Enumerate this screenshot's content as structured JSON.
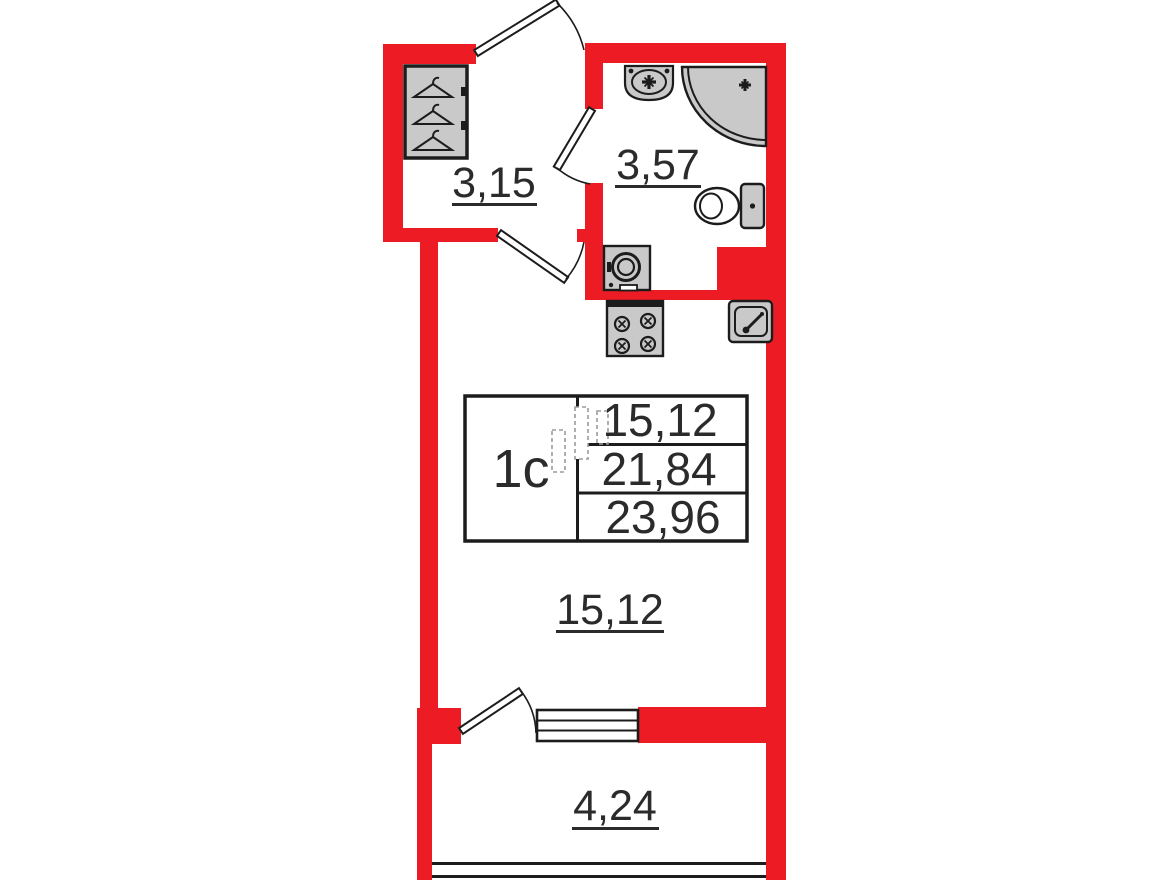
{
  "colors": {
    "wall": "#ed1c24",
    "fixture_fill": "#c9c9c9",
    "outline": "#1c1c1c",
    "label_text": "#2b2b2b"
  },
  "info_box": {
    "unit_type": "1c",
    "values": [
      "15,12",
      "21,84",
      "23,96"
    ]
  },
  "room_labels": {
    "entry_hall": "3,15",
    "bathroom": "3,57",
    "main_room": "15,12",
    "balcony": "4,24"
  },
  "fixture_icons": [
    "wardrobe-hangers-icon",
    "bathroom-sink-icon",
    "corner-shower-icon",
    "toilet-icon",
    "washing-machine-icon",
    "stove-icon",
    "kitchen-sink-icon",
    "entrance-door-icon",
    "bathroom-door-icon",
    "room-door-icon",
    "balcony-door-icon",
    "balcony-window-icon",
    "balcony-glazing-icon",
    "plan-sketch-icon"
  ]
}
